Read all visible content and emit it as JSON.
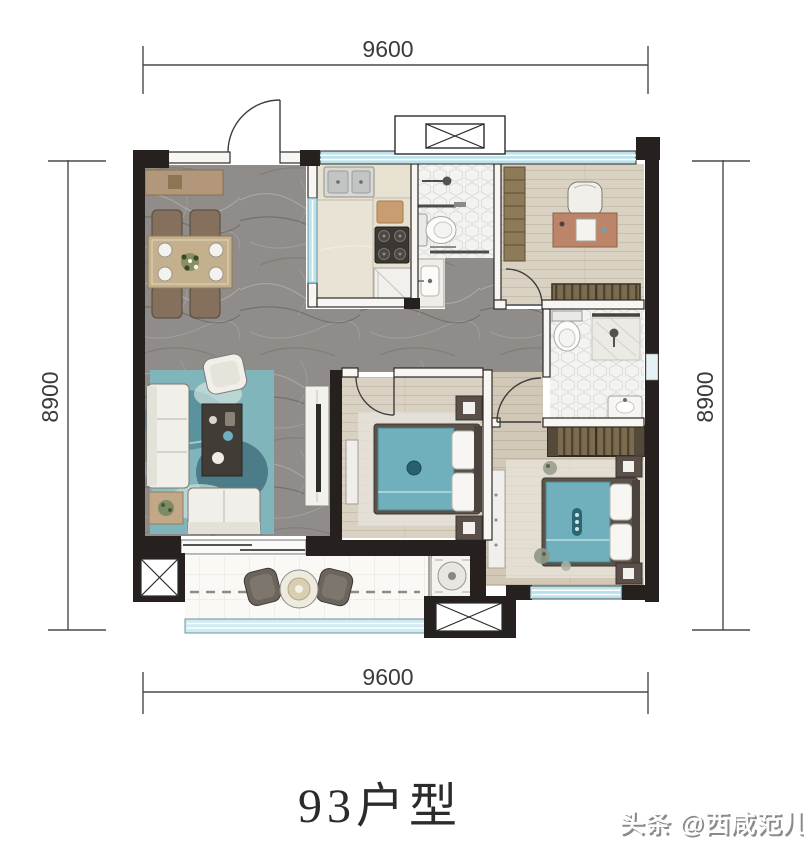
{
  "plan": {
    "title": "93户型",
    "watermark": "头条 @西咸范儿",
    "dimensions": {
      "top": "9600",
      "bottom": "9600",
      "left": "8900",
      "right": "8900"
    },
    "colors": {
      "wall": "#26211e",
      "window_glass": "#bfe4ea",
      "accent_teal": "#6fb0bc",
      "floor_marble": "#908c89",
      "floor_wood": "#d8d0c2",
      "floor_tile_hex": "#f3f4f2",
      "balcony_tile": "#faf9f6",
      "dimension_text": "#3b3b3b",
      "title_text": "#2b2b2b",
      "watermark_text": "#8f8f8f"
    }
  }
}
